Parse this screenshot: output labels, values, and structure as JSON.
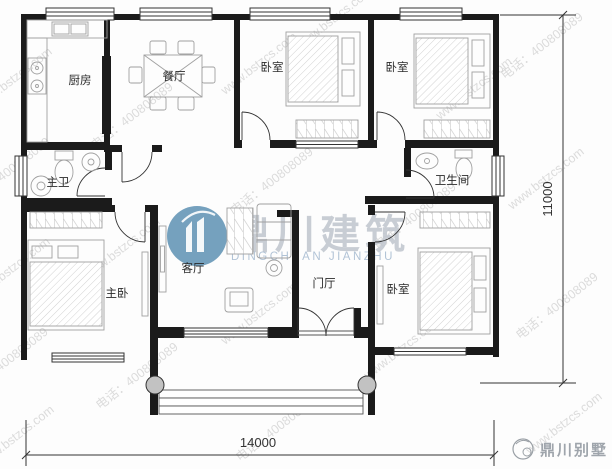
{
  "plan": {
    "room_labels": {
      "kitchen": "厨房",
      "dining": "餐厅",
      "bedroom_top_middle": "卧室",
      "bedroom_top_right": "卧室",
      "master_bath": "主卫",
      "bathroom": "卫生间",
      "master_bedroom": "主卧",
      "living_room": "客厅",
      "entry_hall": "门厅",
      "bedroom_bottom_right": "卧室"
    },
    "dimensions": {
      "overall_width": "14000",
      "overall_height": "11000"
    }
  },
  "watermark": {
    "site": "www.bstzcs.com",
    "phone": "电话：400808089",
    "brand_cn": "鼎川建筑",
    "brand_en": "DINGCHUAN JIANZHU",
    "footer_brand": "鼎川别墅"
  },
  "colors": {
    "wall": "#1b1b1b",
    "furniture_line": "#9c9c9c",
    "watermark_gray": "#c0c0c0",
    "logo_blue": "#4e87ac",
    "brand_text": "#bfc5ce"
  }
}
